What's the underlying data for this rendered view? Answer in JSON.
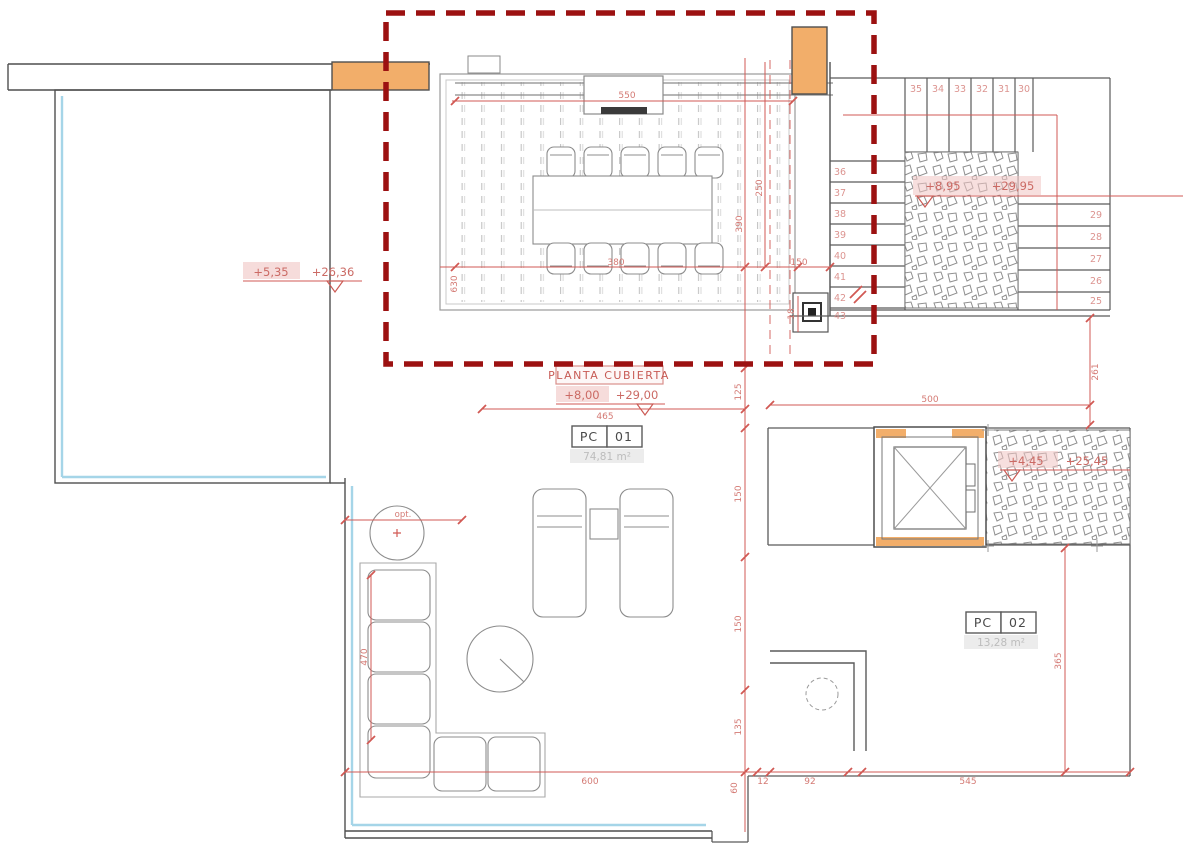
{
  "drawing": {
    "title_box": {
      "title": "PLANTA CUBIERTA",
      "level": "+8,00",
      "elevation": "+29,00"
    },
    "levels": {
      "terrace": {
        "level": "+5,35",
        "elevation": "+26,36"
      },
      "stair_upper": {
        "level": "+8,95",
        "elevation": "+29,95"
      },
      "stair_lower": {
        "level": "+4,45",
        "elevation": "+25,45"
      }
    },
    "rooms": {
      "pc01": {
        "code": "PC",
        "number": "01",
        "area": "74,81 m²"
      },
      "pc02": {
        "code": "PC",
        "number": "02",
        "area": "13,28 m²"
      }
    },
    "stairs": {
      "top_row": [
        "35",
        "34",
        "33",
        "32",
        "31",
        "30"
      ],
      "left_col": [
        "36",
        "37",
        "38",
        "39",
        "40",
        "41",
        "42",
        "43"
      ],
      "right_col": [
        "29",
        "28",
        "27",
        "26",
        "25"
      ]
    },
    "dims": {
      "pergola_width": "550",
      "bay_a": "250",
      "bay_b": "390",
      "dining_width": "380",
      "dining_depth": "630",
      "chimney_offset": "150",
      "chimney_size": "18",
      "gap_a": "125",
      "terrace_width": "465",
      "roof_width": "500",
      "roof_depth": "261",
      "seg_a": "150",
      "seg_b": "150",
      "seg_c": "135",
      "sofa_length": "470",
      "bottom_main": "600",
      "bottom_a": "60",
      "bottom_b": "12",
      "bottom_c": "92",
      "bottom_d": "545",
      "right_depth": "365",
      "note": "opt."
    },
    "colors": {
      "dimension_red": "#cf5a55",
      "highlight_red": "#9c1111",
      "wall_orange": "#f2ae6a",
      "water_cyan": "#a5d5e8",
      "wall_gray": "#4f4f4f",
      "highlight_pink": "#f0c5c3"
    }
  }
}
